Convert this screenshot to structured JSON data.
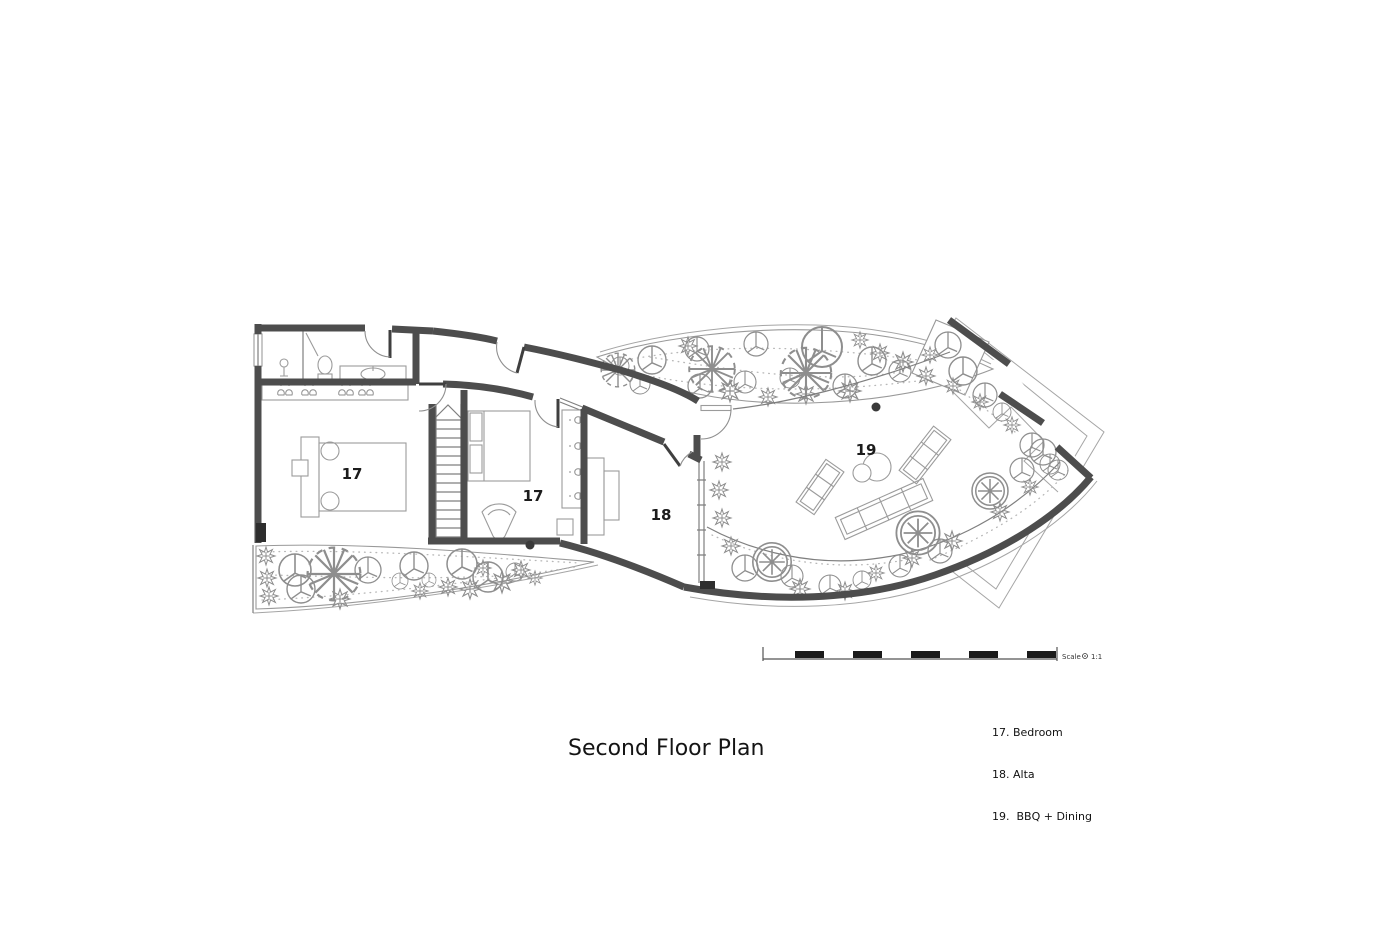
{
  "title": {
    "text": "Second Floor Plan"
  },
  "legend": {
    "items": [
      "17. Bedroom",
      "18. Alta",
      "19.  BBQ + Dining"
    ]
  },
  "room_labels": {
    "bedroom_left": "17",
    "bedroom_right": "17",
    "alta": "18",
    "bbq_dining": "19"
  },
  "scale_bar": {
    "label": "Scale",
    "ratio": "1:1"
  },
  "colors": {
    "wall": "#4d4d4d",
    "thin_line": "#7f7f7f",
    "vegetation_line": "#8e8e8e",
    "text": "#141414",
    "background": "#ffffff"
  }
}
